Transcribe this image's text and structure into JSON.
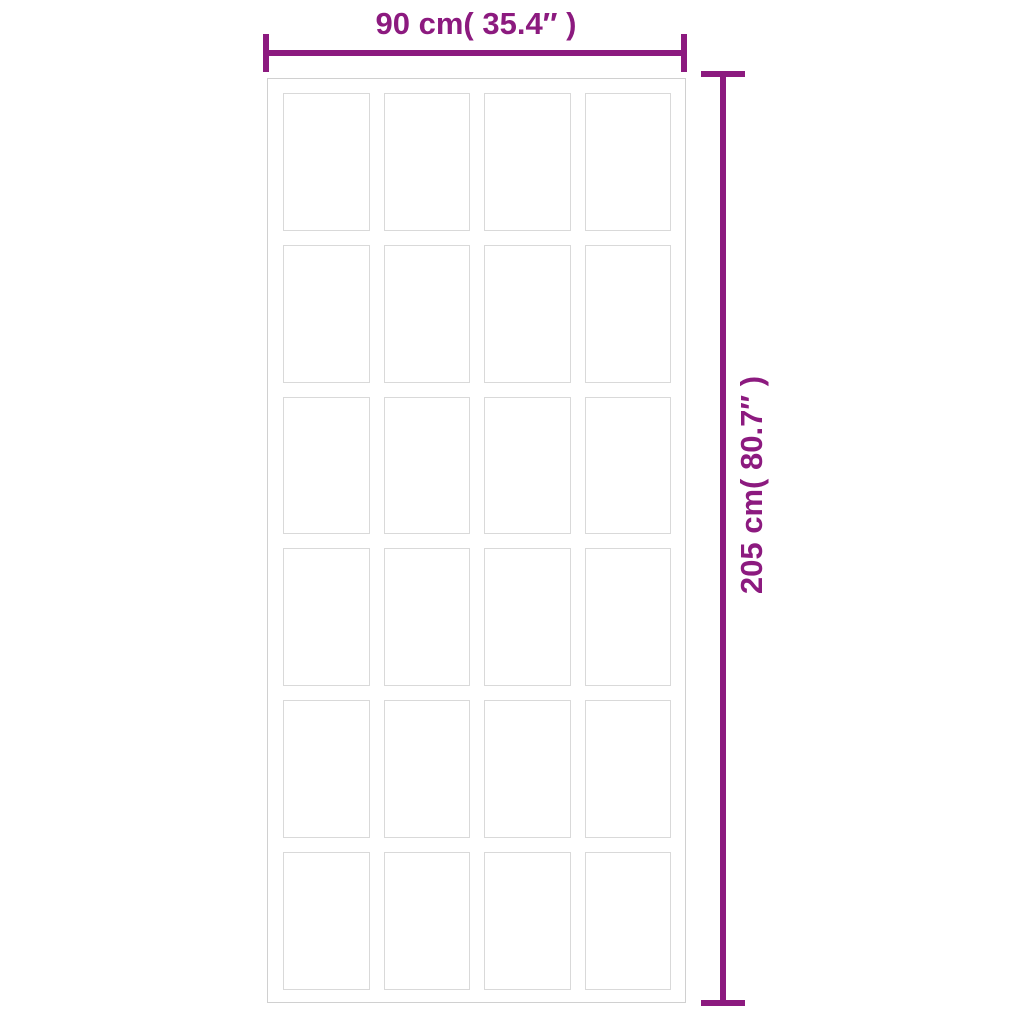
{
  "diagram": {
    "type": "product-dimension-diagram",
    "subject": "sliding door with grid of glass panels",
    "width_dimension": {
      "label": "90 cm( 35.4″ )"
    },
    "height_dimension": {
      "label": "205 cm( 80.7″ )"
    },
    "door": {
      "columns": 4,
      "rows": 6,
      "panel_count": 24
    },
    "colors": {
      "dimension_accent": "#8c1a7f",
      "frame_border": "#d0d0d0",
      "panel_border": "#d9d9d9",
      "background": "#ffffff"
    }
  }
}
